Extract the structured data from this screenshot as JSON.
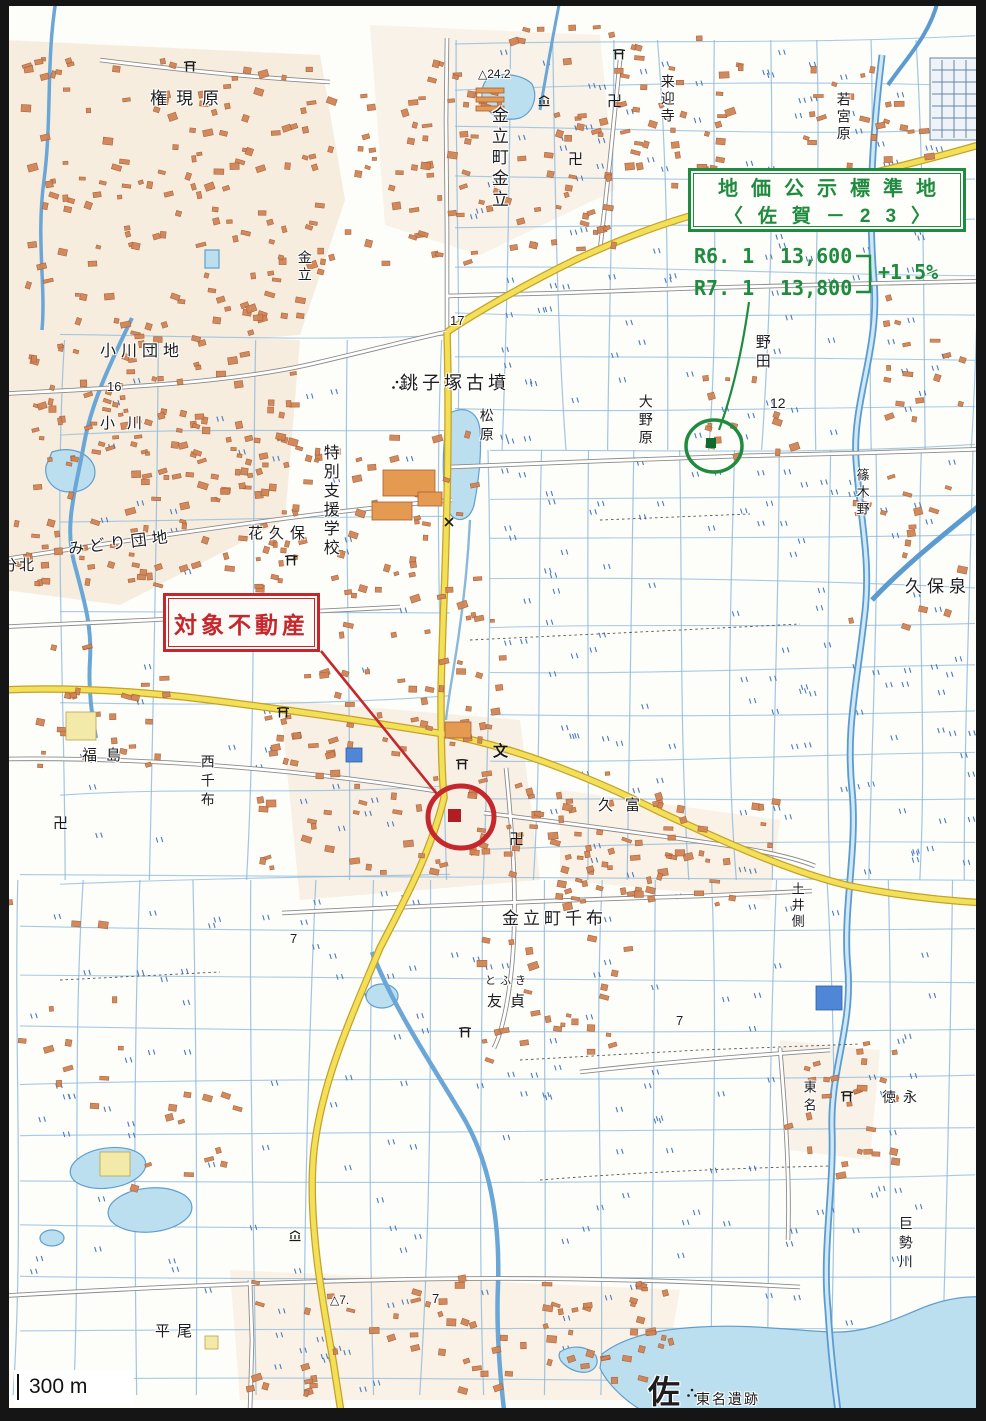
{
  "annotations": {
    "standard_site_box": {
      "line1": "地価公示標準地",
      "line2": "〈佐賀－23〉"
    },
    "prices": [
      {
        "label": "R6. 1",
        "value": "13,600"
      },
      {
        "label": "R7. 1",
        "value": "13,800"
      }
    ],
    "change_label": "+1.5%",
    "subject_property_label": "対象不動産",
    "scale_label": "300 m"
  },
  "colors": {
    "annotation_green": "#1e8b3e",
    "annotation_red": "#c5272d",
    "road_yellow": "#f2e158",
    "water_blue": "#bcdff0"
  },
  "map_labels": [
    {
      "text": "権現原",
      "x": 150,
      "y": 90,
      "size": 17,
      "ls": 9
    },
    {
      "text": "小川団地",
      "x": 100,
      "y": 344,
      "size": 16,
      "ls": 5
    },
    {
      "text": "小川",
      "x": 100,
      "y": 416,
      "size": 15,
      "ls": 12
    },
    {
      "text": "みどり団地",
      "x": 68,
      "y": 536,
      "size": 16,
      "ls": 5,
      "rot": -7
    },
    {
      "text": "分北",
      "x": 2,
      "y": 558,
      "size": 15,
      "ls": 2
    },
    {
      "text": "金立町金立",
      "x": 489,
      "y": 106,
      "size": 17,
      "v": true,
      "ls": 4
    },
    {
      "text": "金立",
      "x": 297,
      "y": 250,
      "size": 14,
      "v": true,
      "ls": 3
    },
    {
      "text": "来迎寺",
      "x": 660,
      "y": 74,
      "size": 14,
      "v": true,
      "ls": 3
    },
    {
      "text": "若宮原",
      "x": 836,
      "y": 92,
      "size": 14,
      "v": true,
      "ls": 3
    },
    {
      "text": "銚子塚古墳",
      "x": 400,
      "y": 374,
      "size": 18,
      "ls": 4
    },
    {
      "text": "松原",
      "x": 479,
      "y": 408,
      "size": 14,
      "v": true,
      "ls": 5
    },
    {
      "text": "大野原",
      "x": 638,
      "y": 394,
      "size": 14,
      "v": true,
      "ls": 4
    },
    {
      "text": "野田",
      "x": 754,
      "y": 334,
      "size": 15,
      "v": true,
      "ls": 4
    },
    {
      "text": "篠木野",
      "x": 855,
      "y": 468,
      "size": 13,
      "v": true,
      "ls": 4
    },
    {
      "text": "久保泉",
      "x": 905,
      "y": 578,
      "size": 17,
      "ls": 5
    },
    {
      "text": "特別支援学校",
      "x": 320,
      "y": 444,
      "size": 16,
      "v": true,
      "ls": 3
    },
    {
      "text": "花久保",
      "x": 248,
      "y": 526,
      "size": 15,
      "ls": 6
    },
    {
      "text": "福島",
      "x": 82,
      "y": 748,
      "size": 15,
      "ls": 9
    },
    {
      "text": "西千布",
      "x": 200,
      "y": 754,
      "size": 14,
      "v": true,
      "ls": 5
    },
    {
      "text": "久富",
      "x": 598,
      "y": 798,
      "size": 15,
      "ls": 12
    },
    {
      "text": "金立町千布",
      "x": 502,
      "y": 910,
      "size": 17,
      "ls": 4
    },
    {
      "text": "土井側",
      "x": 790,
      "y": 882,
      "size": 13,
      "v": true,
      "ls": 3
    },
    {
      "text": "とふき",
      "x": 485,
      "y": 976,
      "size": 11,
      "ls": 4
    },
    {
      "text": "友貞",
      "x": 487,
      "y": 994,
      "size": 15,
      "ls": 8
    },
    {
      "text": "東名",
      "x": 802,
      "y": 1080,
      "size": 13,
      "v": true,
      "ls": 5
    },
    {
      "text": "徳永",
      "x": 882,
      "y": 1090,
      "size": 14,
      "ls": 7
    },
    {
      "text": "巨勢川",
      "x": 898,
      "y": 1216,
      "size": 14,
      "v": true,
      "ls": 5
    },
    {
      "text": "平尾",
      "x": 155,
      "y": 1324,
      "size": 15,
      "ls": 7
    },
    {
      "text": "佐",
      "x": 648,
      "y": 1376,
      "size": 32,
      "bold": true
    },
    {
      "text": "東名遺跡",
      "x": 696,
      "y": 1392,
      "size": 14,
      "ls": 2
    },
    {
      "text": "17",
      "x": 450,
      "y": 314,
      "size": 13,
      "name": "road-number"
    },
    {
      "text": "16",
      "x": 107,
      "y": 380,
      "size": 13,
      "name": "road-number"
    },
    {
      "text": "12",
      "x": 770,
      "y": 396,
      "size": 14,
      "name": "road-number"
    },
    {
      "text": "7",
      "x": 290,
      "y": 932,
      "size": 13,
      "name": "spot-number"
    },
    {
      "text": "7",
      "x": 676,
      "y": 1014,
      "size": 13,
      "name": "spot-number"
    },
    {
      "text": "7",
      "x": 432,
      "y": 1292,
      "size": 13,
      "name": "spot-number"
    },
    {
      "text": "△7.",
      "x": 330,
      "y": 1294,
      "size": 12,
      "name": "spot-elevation"
    },
    {
      "text": "8",
      "x": 2,
      "y": 972,
      "size": 13,
      "name": "spot-number"
    },
    {
      "text": "△24.2",
      "x": 478,
      "y": 68,
      "size": 12,
      "name": "spot-elevation"
    }
  ],
  "map_icons": [
    {
      "type": "temple",
      "x": 607,
      "y": 90
    },
    {
      "type": "temple",
      "x": 568,
      "y": 148
    },
    {
      "type": "temple",
      "x": 53,
      "y": 812
    },
    {
      "type": "temple",
      "x": 509,
      "y": 828
    },
    {
      "type": "torii",
      "x": 183,
      "y": 60
    },
    {
      "type": "torii",
      "x": 612,
      "y": 48
    },
    {
      "type": "torii",
      "x": 284,
      "y": 554
    },
    {
      "type": "torii",
      "x": 276,
      "y": 706
    },
    {
      "type": "torii",
      "x": 455,
      "y": 758
    },
    {
      "type": "torii",
      "x": 458,
      "y": 1026
    },
    {
      "type": "torii",
      "x": 840,
      "y": 1090
    },
    {
      "type": "museum",
      "x": 537,
      "y": 95
    },
    {
      "type": "museum",
      "x": 288,
      "y": 1230
    },
    {
      "type": "school",
      "x": 493,
      "y": 740
    },
    {
      "type": "police",
      "x": 444,
      "y": 517
    },
    {
      "type": "hist",
      "x": 391,
      "y": 380
    },
    {
      "type": "hist",
      "x": 686,
      "y": 1388
    }
  ]
}
